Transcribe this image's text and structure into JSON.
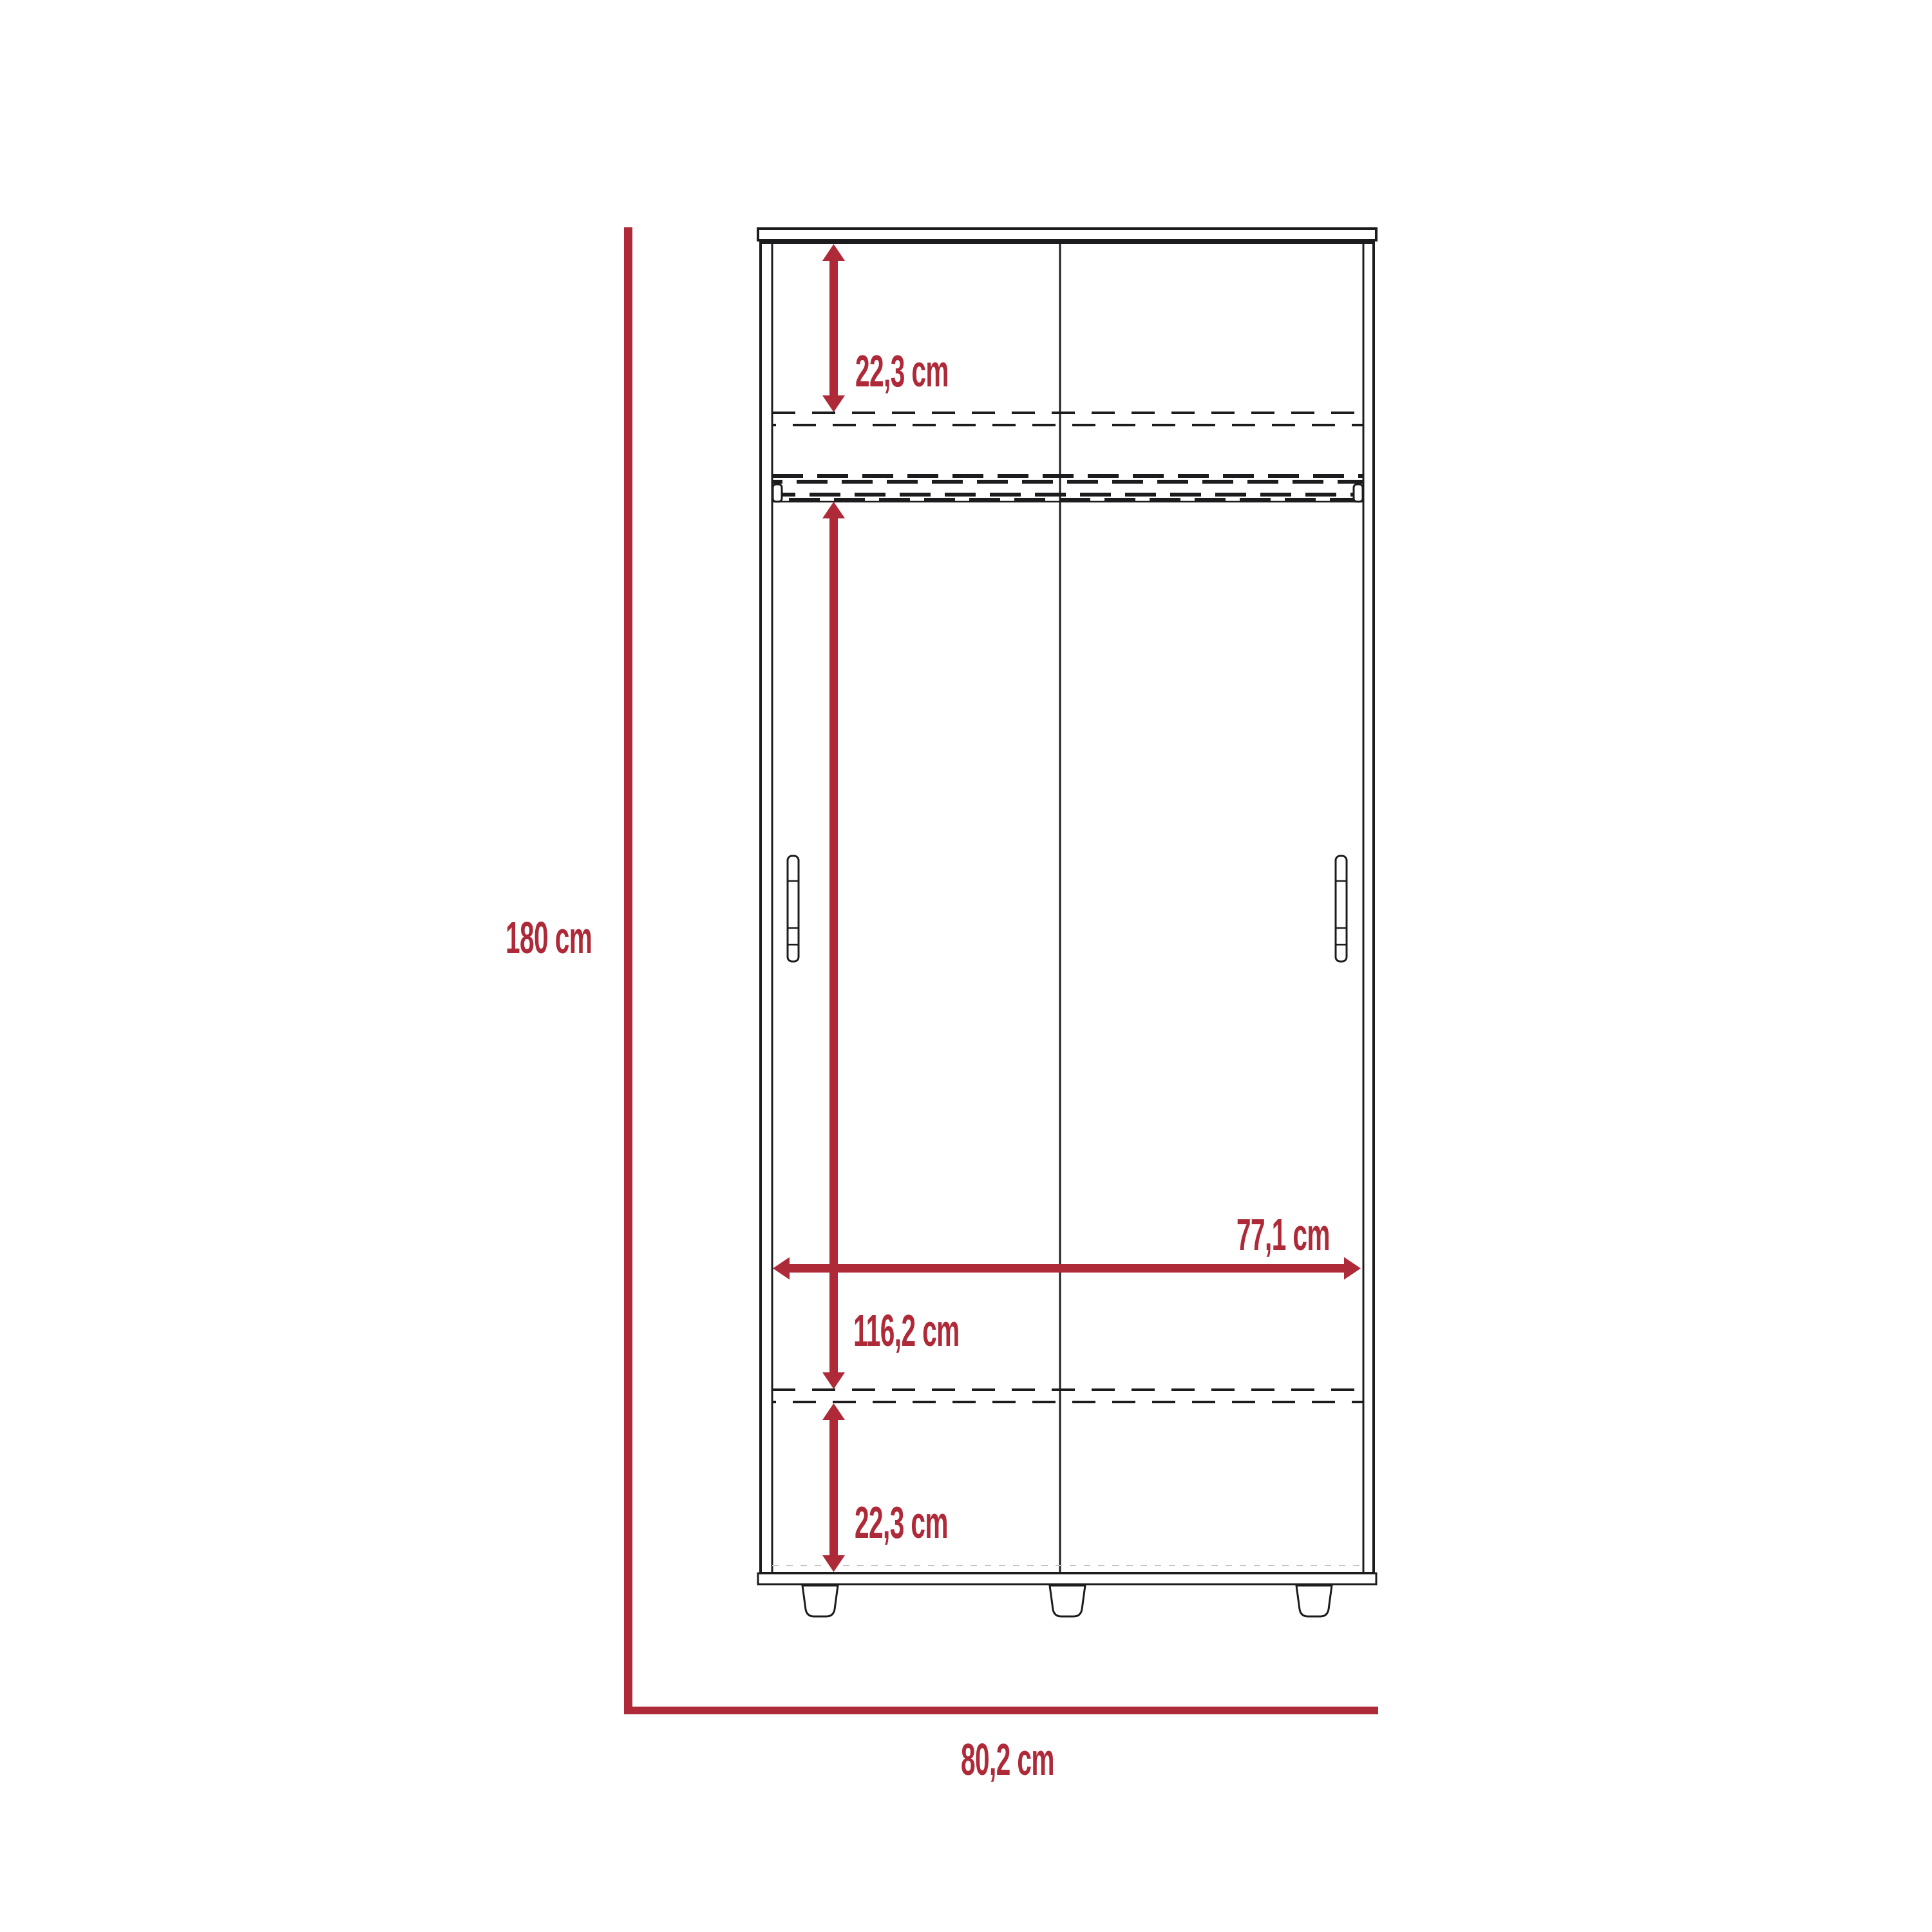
{
  "diagram": {
    "type": "furniture-dimension-diagram",
    "subject": "sliding-door wardrobe front elevation",
    "unit": "cm"
  },
  "colors": {
    "dimension_red": "#AE2A38",
    "outline_black": "#1C1C1E",
    "background": "#FFFFFF"
  },
  "labels": {
    "overall_height": "180 cm",
    "overall_width": "80,2 cm",
    "top_shelf_height": "22,3 cm",
    "hanging_section_height": "116,2 cm",
    "bottom_section_height": "22,3 cm",
    "interior_width": "77,1 cm"
  }
}
